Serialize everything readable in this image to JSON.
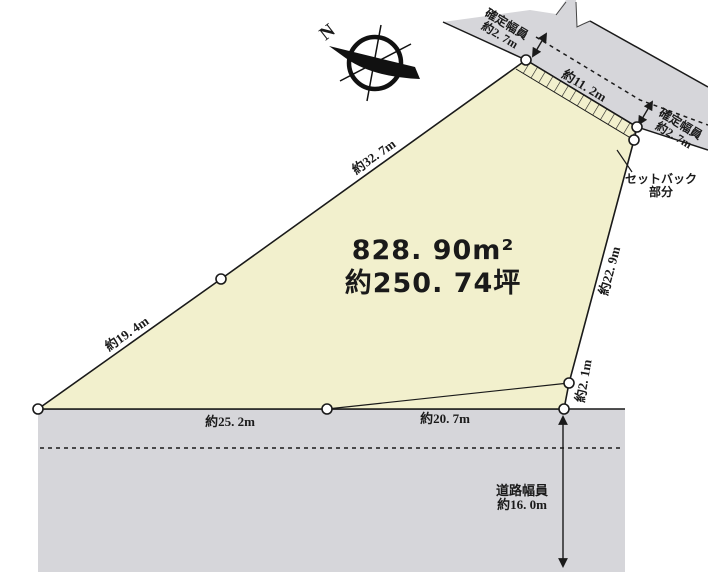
{
  "diagram": {
    "title": "land-plot-survey-diagram",
    "area": {
      "square_meters": "828. 90m²",
      "tsubo": "約250. 74坪"
    },
    "edges": {
      "top_left": "約32. 7m",
      "left": "約19. 4m",
      "bottom_left": "約25. 2m",
      "bottom_right": "約20. 7m",
      "right_upper": "約22. 9m",
      "right_lower": "約2. 1m",
      "road_frontage": "約11. 2m"
    },
    "annotations": {
      "confirmed_width_top": {
        "line1": "確定幅員",
        "line2": "約2. 7m"
      },
      "confirmed_width_right": {
        "line1": "確定幅員",
        "line2": "約2. 7m"
      },
      "setback": {
        "line1": "セットバック",
        "line2": "部分"
      },
      "road_width": {
        "line1": "道路幅員",
        "line2": "約16. 0m"
      },
      "compass_north": "N"
    },
    "colors": {
      "parcel_fill": "#f2f0cd",
      "road_fill": "#d6d6da",
      "line": "#1a1a1a"
    }
  }
}
